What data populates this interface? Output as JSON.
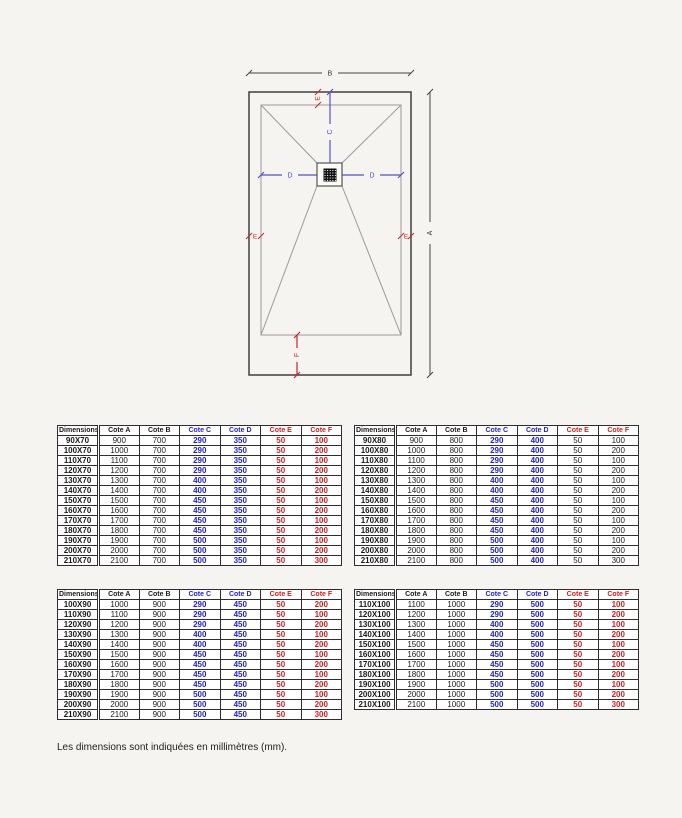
{
  "page": {
    "footer_note": "Les dimensions sont indiquées en millimètres (mm)."
  },
  "diagram": {
    "labels": {
      "a": "A",
      "b": "B",
      "c": "C",
      "d_left": "D",
      "d_right": "D",
      "e_top": "E",
      "e_left": "E",
      "e_right": "E",
      "f": "F"
    },
    "colors": {
      "outline": "#3f3f3f",
      "inner_lines": "#9a9a9a",
      "dim_dark": "#444444",
      "dim_blue": "#5252cc",
      "dim_red": "#cc2323",
      "drain": "#111111"
    }
  },
  "table_headers": [
    "Dimensions",
    "Cote A",
    "Cote B",
    "Cote C",
    "Cote D",
    "Cote E",
    "Cote F"
  ],
  "tables": [
    {
      "name": "table-70",
      "ef_color": "red",
      "rows": [
        [
          "90X70",
          "900",
          "700",
          "290",
          "350",
          "50",
          "100"
        ],
        [
          "100X70",
          "1000",
          "700",
          "290",
          "350",
          "50",
          "200"
        ],
        [
          "110X70",
          "1100",
          "700",
          "290",
          "350",
          "50",
          "100"
        ],
        [
          "120X70",
          "1200",
          "700",
          "290",
          "350",
          "50",
          "200"
        ],
        [
          "130X70",
          "1300",
          "700",
          "400",
          "350",
          "50",
          "100"
        ],
        [
          "140X70",
          "1400",
          "700",
          "400",
          "350",
          "50",
          "200"
        ],
        [
          "150X70",
          "1500",
          "700",
          "450",
          "350",
          "50",
          "100"
        ],
        [
          "160X70",
          "1600",
          "700",
          "450",
          "350",
          "50",
          "200"
        ],
        [
          "170X70",
          "1700",
          "700",
          "450",
          "350",
          "50",
          "100"
        ],
        [
          "180X70",
          "1800",
          "700",
          "450",
          "350",
          "50",
          "200"
        ],
        [
          "190X70",
          "1900",
          "700",
          "500",
          "350",
          "50",
          "100"
        ],
        [
          "200X70",
          "2000",
          "700",
          "500",
          "350",
          "50",
          "200"
        ],
        [
          "210X70",
          "2100",
          "700",
          "500",
          "350",
          "50",
          "300"
        ]
      ]
    },
    {
      "name": "table-80",
      "ef_color": "black",
      "rows": [
        [
          "90X80",
          "900",
          "800",
          "290",
          "400",
          "50",
          "100"
        ],
        [
          "100X80",
          "1000",
          "800",
          "290",
          "400",
          "50",
          "200"
        ],
        [
          "110X80",
          "1100",
          "800",
          "290",
          "400",
          "50",
          "100"
        ],
        [
          "120X80",
          "1200",
          "800",
          "290",
          "400",
          "50",
          "200"
        ],
        [
          "130X80",
          "1300",
          "800",
          "400",
          "400",
          "50",
          "100"
        ],
        [
          "140X80",
          "1400",
          "800",
          "400",
          "400",
          "50",
          "200"
        ],
        [
          "150X80",
          "1500",
          "800",
          "450",
          "400",
          "50",
          "100"
        ],
        [
          "160X80",
          "1600",
          "800",
          "450",
          "400",
          "50",
          "200"
        ],
        [
          "170X80",
          "1700",
          "800",
          "450",
          "400",
          "50",
          "100"
        ],
        [
          "180X80",
          "1800",
          "800",
          "450",
          "400",
          "50",
          "200"
        ],
        [
          "190X80",
          "1900",
          "800",
          "500",
          "400",
          "50",
          "100"
        ],
        [
          "200X80",
          "2000",
          "800",
          "500",
          "400",
          "50",
          "200"
        ],
        [
          "210X80",
          "2100",
          "800",
          "500",
          "400",
          "50",
          "300"
        ]
      ]
    },
    {
      "name": "table-90",
      "ef_color": "red",
      "rows": [
        [
          "100X90",
          "1000",
          "900",
          "290",
          "450",
          "50",
          "200"
        ],
        [
          "110X90",
          "1100",
          "900",
          "290",
          "450",
          "50",
          "100"
        ],
        [
          "120X90",
          "1200",
          "900",
          "290",
          "450",
          "50",
          "200"
        ],
        [
          "130X90",
          "1300",
          "900",
          "400",
          "450",
          "50",
          "100"
        ],
        [
          "140X90",
          "1400",
          "900",
          "400",
          "450",
          "50",
          "200"
        ],
        [
          "150X90",
          "1500",
          "900",
          "450",
          "450",
          "50",
          "100"
        ],
        [
          "160X90",
          "1600",
          "900",
          "450",
          "450",
          "50",
          "200"
        ],
        [
          "170X90",
          "1700",
          "900",
          "450",
          "450",
          "50",
          "100"
        ],
        [
          "180X90",
          "1800",
          "900",
          "450",
          "450",
          "50",
          "200"
        ],
        [
          "190X90",
          "1900",
          "900",
          "500",
          "450",
          "50",
          "100"
        ],
        [
          "200X90",
          "2000",
          "900",
          "500",
          "450",
          "50",
          "200"
        ],
        [
          "210X90",
          "2100",
          "900",
          "500",
          "450",
          "50",
          "300"
        ]
      ]
    },
    {
      "name": "table-100",
      "ef_color": "red",
      "rows": [
        [
          "110X100",
          "1100",
          "1000",
          "290",
          "500",
          "50",
          "100"
        ],
        [
          "120X100",
          "1200",
          "1000",
          "290",
          "500",
          "50",
          "200"
        ],
        [
          "130X100",
          "1300",
          "1000",
          "400",
          "500",
          "50",
          "100"
        ],
        [
          "140X100",
          "1400",
          "1000",
          "400",
          "500",
          "50",
          "200"
        ],
        [
          "150X100",
          "1500",
          "1000",
          "450",
          "500",
          "50",
          "100"
        ],
        [
          "160X100",
          "1600",
          "1000",
          "450",
          "500",
          "50",
          "200"
        ],
        [
          "170X100",
          "1700",
          "1000",
          "450",
          "500",
          "50",
          "100"
        ],
        [
          "180X100",
          "1800",
          "1000",
          "450",
          "500",
          "50",
          "200"
        ],
        [
          "190X100",
          "1900",
          "1000",
          "500",
          "500",
          "50",
          "100"
        ],
        [
          "200X100",
          "2000",
          "1000",
          "500",
          "500",
          "50",
          "200"
        ],
        [
          "210X100",
          "2100",
          "1000",
          "500",
          "500",
          "50",
          "300"
        ]
      ]
    }
  ]
}
